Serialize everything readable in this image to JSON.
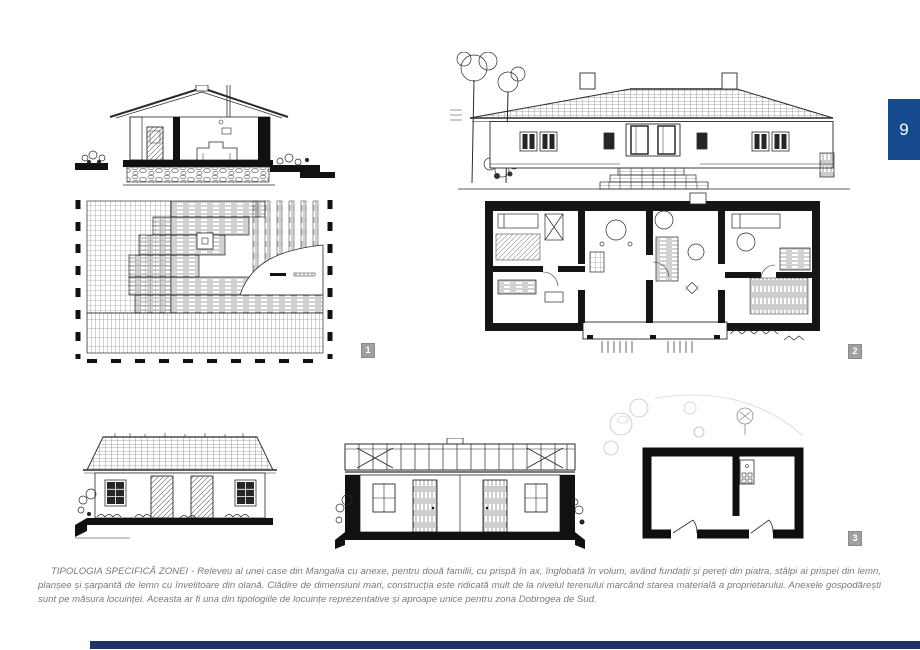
{
  "page": {
    "number": "9",
    "background": "#ffffff",
    "tab_color": "#164a8f",
    "footer_bar_color": "#1d3464",
    "badge_color": "#a0a0a0",
    "ink_color": "#2a2a2a"
  },
  "figures": {
    "f1": {
      "badge": "1"
    },
    "f2": {
      "badge": "2"
    },
    "f3": {
      "badge": "3"
    }
  },
  "caption": {
    "lead": "TIPOLOGIA SPECIFICĂ ZONEI",
    "body": "- Releveu al unei case din Mangalia cu anexe, pentru două familii, cu prispă în ax, înglobată în volum, având fundații și pereți din piatra, stâlpi ai prispei din lemn, planșee și șarpantă de lemn cu învelitoare din olană. Clădire de dimensiuni mari, construcția este ridicată mult de la nivelul terenului marcând starea materială a proprietarului. Anexele gospodărești sunt pe măsura locuinței. Aceasta ar fi una din tipologiile de locuințe reprezentative și aproape unice pentru zona Dobrogea de Sud."
  }
}
